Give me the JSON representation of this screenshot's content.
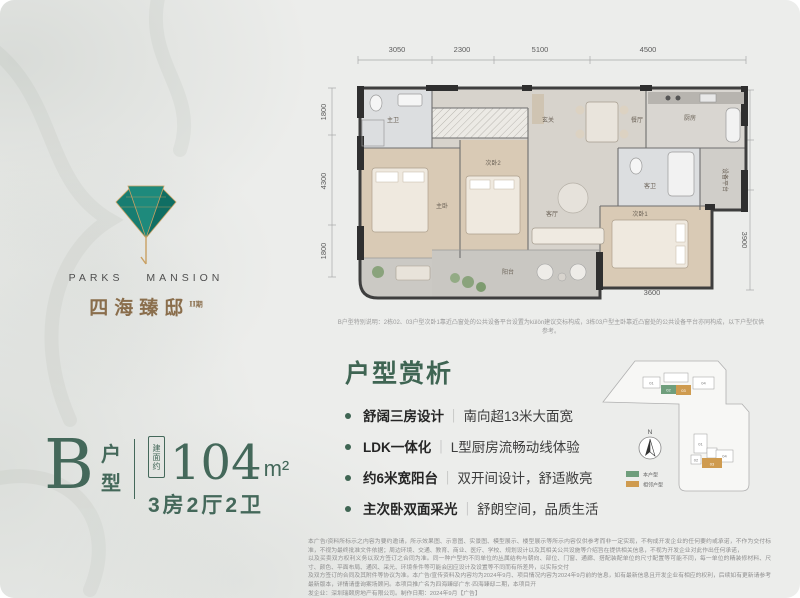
{
  "brand": {
    "name_en": "PARKS MANSION",
    "name_cn": "四海臻邸",
    "phase": "II期"
  },
  "unit_card": {
    "letter": "B",
    "suffix_top": "户",
    "suffix_bottom": "型",
    "area_tag": "建面约",
    "area_value": "104",
    "area_unit": "m²",
    "layout": "3房2厅2卫"
  },
  "floorplan": {
    "dims_top": [
      "3050",
      "2300",
      "5100",
      "4500"
    ],
    "dims_left": [
      "1800",
      "4300",
      "1800"
    ],
    "dims_right": [
      "2000",
      "2000",
      "3900"
    ],
    "dims_bottom": [
      "3300",
      "2650",
      "3500",
      "3600"
    ],
    "rooms": {
      "master_bath": "主卫",
      "master_bedroom": "主卧",
      "foyer": "玄关",
      "dining": "餐厅",
      "kitchen": "厨房",
      "guest_bath": "客卫",
      "bedroom2": "次卧2",
      "living": "客厅",
      "bedroom1": "次卧1",
      "balcony": "阳台",
      "equipment": "设备平台"
    },
    "note": "B户型特别说明：2栋02、03户型次卧1靠近凸窗处的公共设备平台设置为külön建议交标构成，3栋03户型主卧靠近凸窗处的公共设备平台亦同构成，以下户型仅供参考。"
  },
  "analysis": {
    "title": "户型赏析",
    "separator": "｜",
    "bullets": [
      {
        "bold": "舒阔三房设计",
        "text": "南向超13米大面宽"
      },
      {
        "bold": "LDK一体化",
        "text": "L型厨房流畅动线体验"
      },
      {
        "bold": "约6米宽阳台",
        "text": "双开间设计，舒适敞亮"
      },
      {
        "bold": "主次卧双面采光",
        "text": "舒朗空间，品质生活"
      }
    ]
  },
  "keyplan": {
    "north_label": "N",
    "legend_self": "本户型",
    "legend_adjacent": "相邻户型",
    "self_color": "#6f9e7c",
    "adjacent_color": "#cf9b4f",
    "top_building_units": [
      "01",
      "02",
      "03",
      "04"
    ],
    "bottom_building_units": [
      "01",
      "02",
      "03",
      "04"
    ]
  },
  "disclaimer": {
    "lines": [
      "本广告/资料所标示之内容为要约邀请，所示效果图、示意图、实景图、模型展示、楼型展示等所示内容仅供参考而非一定实现，不构成开发企业的任何要约或承诺，不作为交付标准，不视为最终批准文件依据；周边环境、交通、教育、商业、医疗、学校、规划设计以及其相关公共设施等介绍旨在提供相关信息，不视为开发企业对此作出任何承诺，",
      "以及买卖双方权利义务以双方签订之合同为准。同一种户型的不同单位的丛属结构与朝向、部位、门窗、通廊、搭配装配单位的尺寸配置等可能不同，每一单位的精装修材料、尺寸、颜色、平面布局、通风、采光、环境条件等可能会因应设计及设置等不同而有所差异，以实际交付",
      "及双方签订的合同及其附件等协议为准。本广告/宣传资料及内容均为2024年9月、项目情况内容为2024年9月前的信息，如有最新信息且开发企业有相应的权利，后续如有更新请参考最新版本，详情请垂询案场顾问。本项目推广名为四海臻邸广东·四海臻邸二期，本项目开",
      "发企业：深圳瑞颐房地产有限公司。制作日期：2024年9月【广告】"
    ]
  },
  "colors": {
    "accent_green": "#44685a",
    "title_green": "#3f6553",
    "logo_teal": "#1e8a7c",
    "logo_gold": "#c9a063",
    "brand_bronze": "#8a6e4c"
  }
}
